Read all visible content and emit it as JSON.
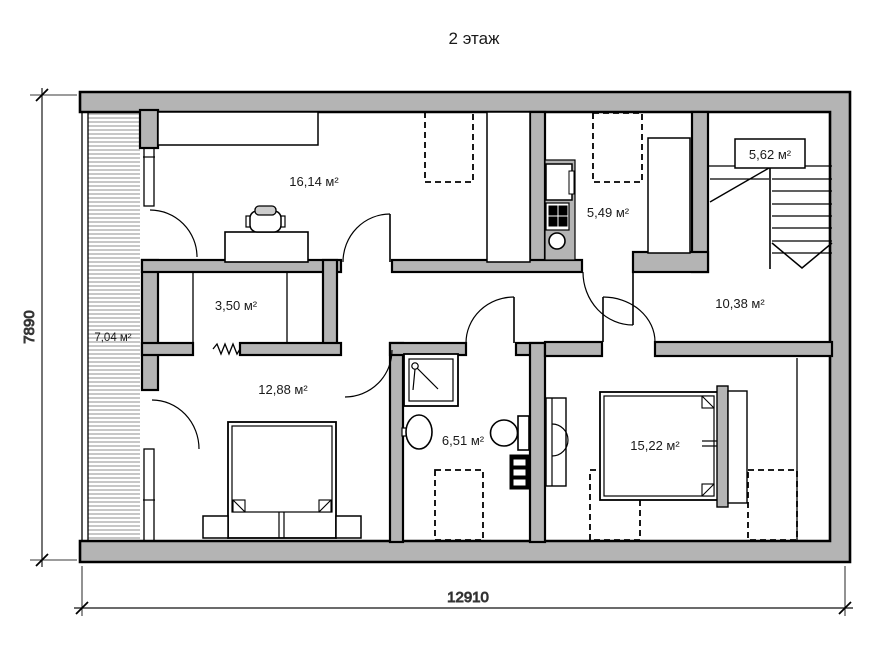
{
  "title": "2 этаж",
  "dimensions": {
    "width_mm": "12910",
    "height_mm": "7890"
  },
  "rooms": [
    {
      "id": "study",
      "area_label": "16,14 м²"
    },
    {
      "id": "kitchen",
      "area_label": "5,49 м²"
    },
    {
      "id": "stairs",
      "area_label": "5,62 м²"
    },
    {
      "id": "closet",
      "area_label": "3,50 м²"
    },
    {
      "id": "hallway",
      "area_label": "10,38 м²"
    },
    {
      "id": "balcony",
      "area_label": "7,04 м²"
    },
    {
      "id": "bedroom-1",
      "area_label": "12,88 м²"
    },
    {
      "id": "bathroom",
      "area_label": "6,51 м²"
    },
    {
      "id": "bedroom-2",
      "area_label": "15,22 м²"
    }
  ],
  "colors": {
    "wall_fill": "#b4b4b4",
    "line": "#000000",
    "background": "#ffffff"
  }
}
